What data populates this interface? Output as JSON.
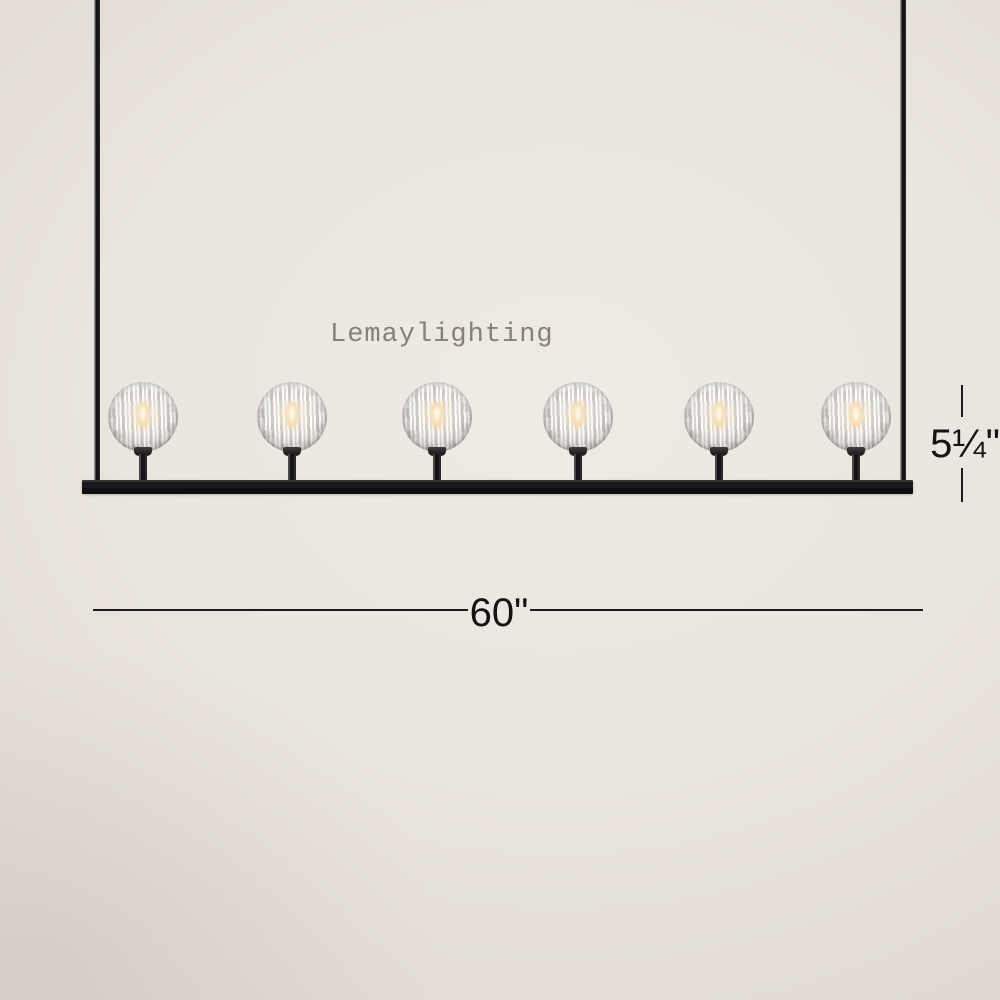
{
  "watermark": {
    "text": "Lemaylighting",
    "color": "#868079"
  },
  "dimensions": {
    "height_label": "5¼\"",
    "width_label": "60\""
  },
  "fixture": {
    "description": "linear chandelier with faceted crystal ball shades on a black frame",
    "lights_count": 6,
    "frame_color": "#17161a",
    "crystal_color": "#f3f1ef",
    "glow_color": "#f4d9ae"
  },
  "background": {
    "center_color": "#f0eae5",
    "edge_color": "#d3ccc6"
  }
}
